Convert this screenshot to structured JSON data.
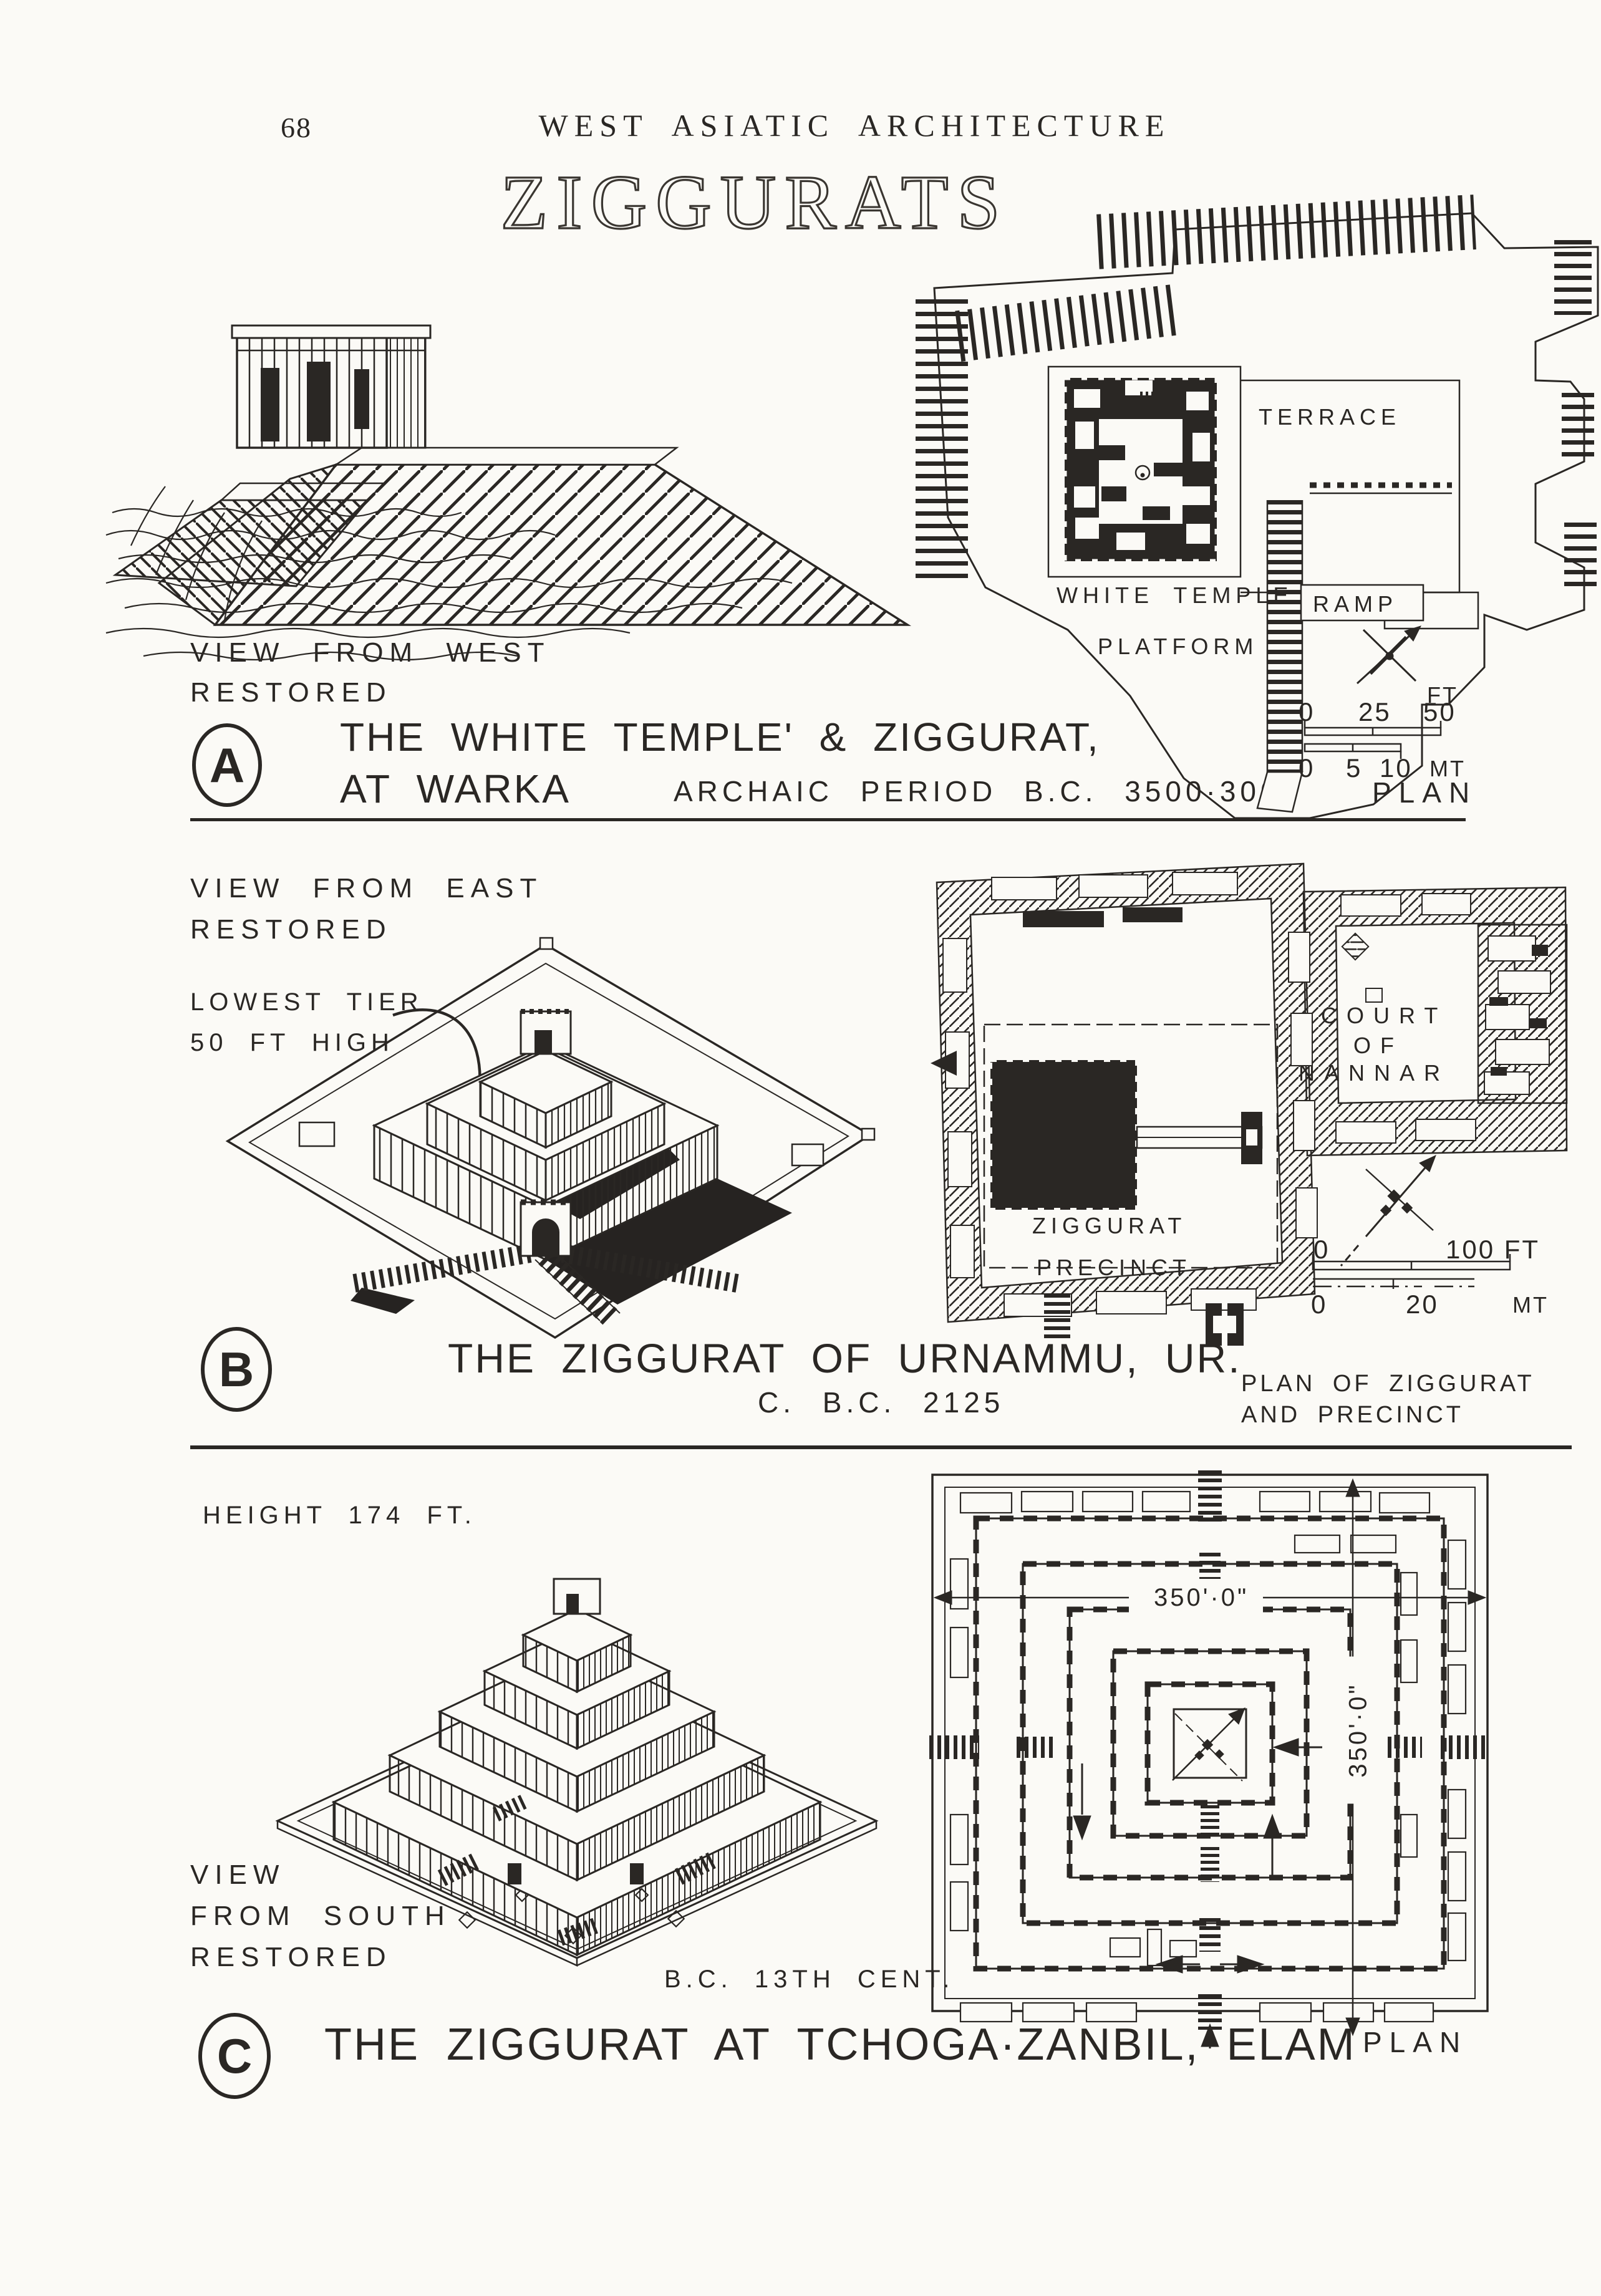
{
  "colors": {
    "ink": "#2a2724",
    "paper": "#fbfaf6"
  },
  "page": {
    "number": "68",
    "header": "WEST ASIATIC ARCHITECTURE",
    "title": "ZIGGURATS"
  },
  "section_a": {
    "marker": "A",
    "view_line1": "VIEW FROM WEST",
    "view_line2": "RESTORED",
    "caption_line1": "THE WHITE TEMPLE' & ZIGGURAT,",
    "caption_line2": "AT WARKA",
    "period": "ARCHAIC PERIOD B.C. 3500·3000",
    "plan": {
      "terrace": "TERRACE",
      "white_temple": "WHITE TEMPLE",
      "ramp": "RAMP",
      "platform": "PLATFORM",
      "plan_label": "PLAN",
      "scale": {
        "ft_unit": "FT",
        "ft0": "0",
        "ft25": "25",
        "ft50": "50",
        "mt0": "0",
        "mt5": "5",
        "mt10": "10",
        "mt_unit": "MT"
      }
    }
  },
  "section_b": {
    "marker": "B",
    "view_line1": "VIEW FROM EAST",
    "view_line2": "RESTORED",
    "note_line1": "LOWEST TIER",
    "note_line2": "50 FT HIGH",
    "caption": "THE ZIGGURAT OF URNAMMU, UR.",
    "date": "C. B.C. 2125",
    "plan": {
      "court_line1": "COURT",
      "court_line2": "OF",
      "court_line3": "NANNAR",
      "precinct_line1": "ZIGGURAT",
      "precinct_line2": "PRECINCT",
      "note_line1": "PLAN OF ZIGGURAT",
      "note_line2": "AND PRECINCT",
      "scale": {
        "ft0": "0",
        "ft100": "100 FT",
        "mt0": "0",
        "mt20": "20",
        "mt_unit": "MT"
      }
    }
  },
  "section_c": {
    "marker": "C",
    "height_label": "HEIGHT 174 FT.",
    "view_line1": "VIEW",
    "view_line2": "FROM SOUTH",
    "view_line3": "RESTORED",
    "date": "B.C. 13TH CENT.",
    "caption": "THE ZIGGURAT AT TCHOGA·ZANBIL, ELAM",
    "plan": {
      "plan_label": "PLAN",
      "dim_w": "350'·0\"",
      "dim_h": "350'·0\""
    }
  }
}
